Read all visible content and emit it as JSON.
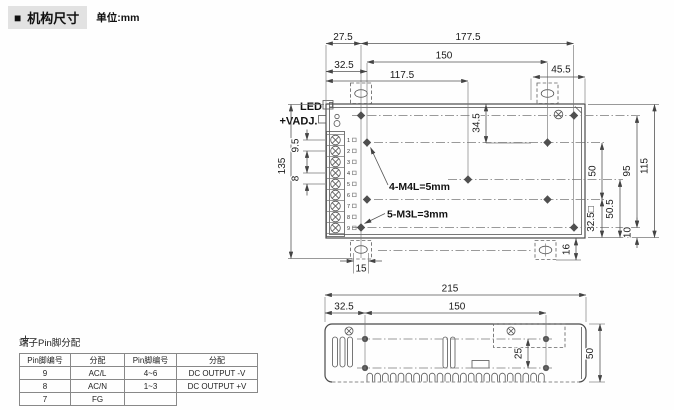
{
  "header": {
    "bullet": "■",
    "title": "机构尺寸",
    "unit": "单位:mm"
  },
  "top_view": {
    "led_label": "LED",
    "vadj_label": "+VADJ.",
    "terminal_numbers": [
      "1",
      "2",
      "3",
      "4",
      "5",
      "6",
      "7",
      "8",
      "9"
    ],
    "note_m4": "4-M4L=5mm",
    "note_m3": "5-M3L=3mm",
    "dims": {
      "left_to_slot": "27.5",
      "slot_to_hole": "177.5",
      "hole_span": "150",
      "left_to_m4": "32.5",
      "left_to_center": "117.5",
      "bracket_right": "45.5",
      "top_to_m4": "34.5",
      "m4_vertical": "50",
      "m4_to_bottom": "32.5□",
      "center_to_bottom": "50.5",
      "hole_rows": "95",
      "case_depth": "115",
      "bottom_offset": "10",
      "slot_width": "15",
      "bracket_drop": "16",
      "overall_height": "135",
      "pitch_top": "9.5",
      "pitch_mid": "8"
    }
  },
  "side_view": {
    "dims": {
      "overall": "215",
      "left_to_hole": "32.5",
      "hole_span": "150",
      "hole_gap": "25",
      "height": "50"
    }
  },
  "pin_table": {
    "title": "端子Pin脚分配",
    "headers": [
      "Pin脚编号",
      "分配",
      "Pin脚编号",
      "分配"
    ],
    "rows": [
      [
        "9",
        "AC/L",
        "4~6",
        "DC OUTPUT -V"
      ],
      [
        "8",
        "AC/N",
        "1~3",
        "DC OUTPUT +V"
      ],
      [
        "7",
        "FG",
        "",
        ""
      ]
    ]
  }
}
